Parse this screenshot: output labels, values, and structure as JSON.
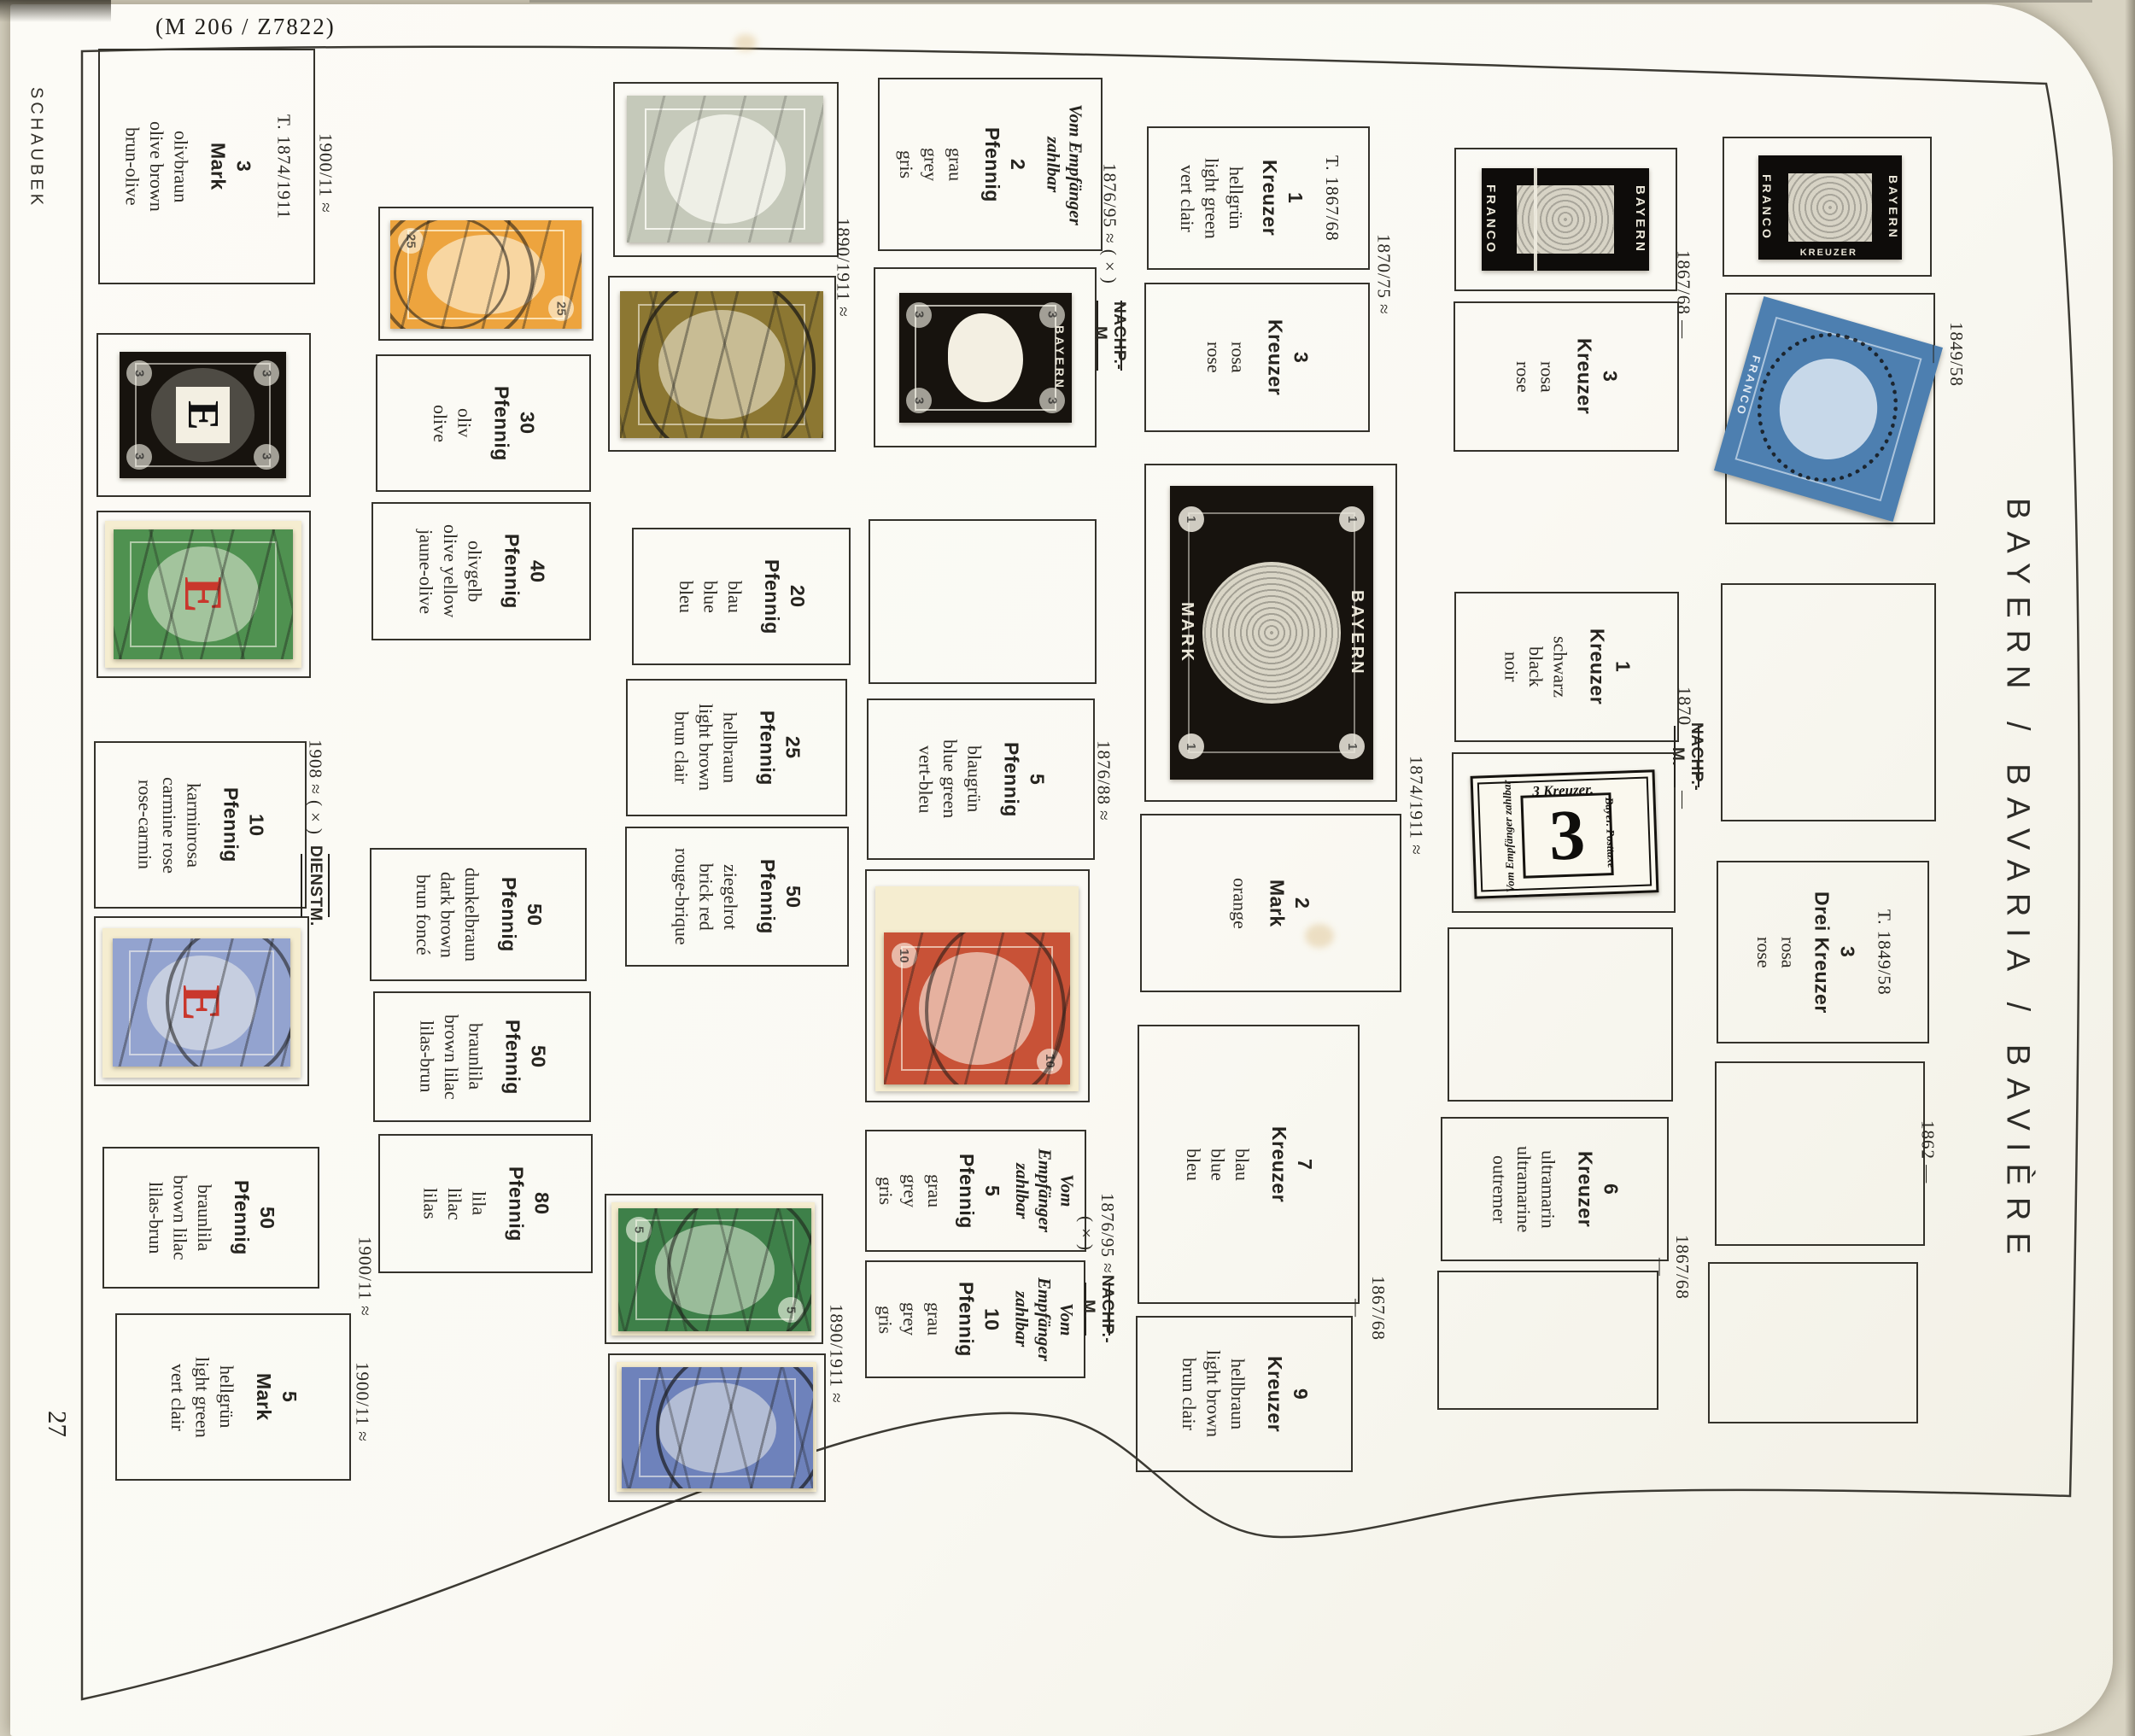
{
  "photo_label": "(M 206 / Z7822)",
  "page": {
    "brand": "SCHAUBEK",
    "number": "27",
    "title": "BAYERN / BAVARIA / BAVIÈRE"
  },
  "palette": {
    "paper": "#faf9f3",
    "frame_ink": "#34322b",
    "orange_stamp": "#eda43e",
    "grey_stamp": "#c5c9ba",
    "olive_stamp": "#8c7732",
    "green_stamp": "#3e8049",
    "blue_stamp": "#6e82bb",
    "red_stamp": "#c85237",
    "official_green": "#4f9150",
    "official_blue": "#93a3cf",
    "black_stamp": "#17130e",
    "blue_1849": "#4d7fb0",
    "overprint_red": "#c9372c",
    "backing": "#f5edd0"
  },
  "annotations": [
    {
      "text": "1900/11 ≈"
    },
    {
      "text": "1908 ≈ (×)"
    },
    {
      "text": "DIENSTM."
    },
    {
      "text": "1900/11 ≈"
    },
    {
      "text": "1900/11 ≈"
    },
    {
      "text": "1890/1911 ≈"
    },
    {
      "text": "1890/1911 ≈"
    },
    {
      "text": "1876/95 ≈ (×)"
    },
    {
      "text": "NACHP.-M."
    },
    {
      "text": "1876/88 ≈"
    },
    {
      "text": "1876/95 ≈ (×)"
    },
    {
      "text": "NACHP.-M."
    },
    {
      "text": "1870/75 ≈"
    },
    {
      "text": "1874/1911 ≈"
    },
    {
      "text": "1867/68 —"
    },
    {
      "text": "1867/68 —"
    },
    {
      "text": "1870"
    },
    {
      "text": "NACHP.-M."
    },
    {
      "text": "—"
    },
    {
      "text": "1867/68 —"
    },
    {
      "text": "1849/58 —"
    },
    {
      "text": "1862 —"
    }
  ],
  "stamp_text": {
    "bayern": "BAYERN",
    "mark": "MARK",
    "franco": "FRANCO",
    "kreuzer": "KREUZER",
    "e": "E",
    "one": "1",
    "due_top": "3 Kreuzer.",
    "due_big": "3",
    "due_left": "Vom Empfänger zahlbar",
    "due_right": "Bayer. Posttaxe"
  },
  "columns": [
    {
      "boxes": [
        {
          "type": "label",
          "header": "T. 1874/1911",
          "vu": [
            "3",
            "Mark"
          ],
          "colors": [
            "olivbraun",
            "olive brown",
            "brun-olive"
          ]
        },
        {
          "type": "stamp",
          "name": "3 Pfennig official black, E overprint",
          "denom": "3"
        },
        {
          "type": "stamp",
          "name": "5 Pfennig official green, red E overprint",
          "denom": "5"
        },
        {
          "type": "label",
          "vu": [
            "10",
            "Pfennig"
          ],
          "colors": [
            "karminrosa",
            "carmine rose",
            "rose-carmin"
          ]
        },
        {
          "type": "stamp",
          "name": "20 Pfennig official ultramarine, red E overprint",
          "denom": "20"
        },
        {
          "type": "label",
          "vu": [
            "50",
            "Pfennig"
          ],
          "colors": [
            "braunlila",
            "brown lilac",
            "lilas-brun"
          ]
        },
        {
          "type": "label",
          "vu": [
            "5",
            "Mark"
          ],
          "colors": [
            "hellgrün",
            "light green",
            "vert clair"
          ]
        }
      ]
    },
    {
      "boxes": [
        {
          "type": "stamp",
          "name": "25 Pfennig orange, used",
          "denom": "25"
        },
        {
          "type": "label",
          "vu": [
            "30",
            "Pfennig"
          ],
          "colors": [
            "oliv",
            "olive"
          ]
        },
        {
          "type": "label",
          "vu": [
            "40",
            "Pfennig"
          ],
          "colors": [
            "olivgelb",
            "olive yellow",
            "jaune-olive"
          ]
        },
        {
          "type": "label",
          "vu": [
            "50",
            "Pfennig"
          ],
          "colors": [
            "dunkelbraun",
            "dark brown",
            "brun foncé"
          ]
        },
        {
          "type": "label",
          "vu": [
            "50",
            "Pfennig"
          ],
          "colors": [
            "braunlila",
            "brown lilac",
            "lilas-brun"
          ]
        },
        {
          "type": "label",
          "vu": [
            "80",
            "Pfennig"
          ],
          "colors": [
            "lila",
            "lilac",
            "lilas"
          ]
        }
      ]
    },
    {
      "boxes": [
        {
          "type": "stamp",
          "name": "2 Pfennig grey, used",
          "denom": "2"
        },
        {
          "type": "stamp",
          "name": "3 Pfennig olive-brown, used",
          "denom": "3"
        },
        {
          "type": "label",
          "vu": [
            "20",
            "Pfennig"
          ],
          "colors": [
            "blau",
            "blue",
            "bleu"
          ]
        },
        {
          "type": "label",
          "vu": [
            "25",
            "Pfennig"
          ],
          "colors": [
            "hellbraun",
            "light brown",
            "brun clair"
          ]
        },
        {
          "type": "label",
          "vu": [
            "50",
            "Pfennig"
          ],
          "colors": [
            "ziegelrot",
            "brick red",
            "rouge-brique"
          ]
        },
        {
          "type": "stamp",
          "name": "5 Pfennig green, used",
          "denom": "5"
        },
        {
          "type": "stamp",
          "name": "20 Pfennig ultramarine, used",
          "denom": "20"
        }
      ]
    },
    {
      "boxes": [
        {
          "type": "label",
          "pre": [
            "Vom Empfänger",
            "zahlbar"
          ],
          "vu": [
            "2",
            "Pfennig"
          ],
          "colors": [
            "grau",
            "grey",
            "gris"
          ]
        },
        {
          "type": "stamp",
          "name": "3 Pfennig postage due, black",
          "denom": "3"
        },
        {
          "type": "empty"
        },
        {
          "type": "label",
          "vu": [
            "5",
            "Pfennig"
          ],
          "colors": [
            "blaugrün",
            "blue green",
            "vert-bleu"
          ]
        },
        {
          "type": "stamp",
          "name": "10 Pfennig vermilion, used",
          "denom": "10"
        },
        {
          "type": "label",
          "pre": [
            "Vom Empfänger",
            "zahlbar"
          ],
          "vu": [
            "5",
            "Pfennig"
          ],
          "colors": [
            "grau",
            "grey",
            "gris"
          ]
        },
        {
          "type": "label",
          "pre": [
            "Vom Empfänger",
            "zahlbar"
          ],
          "vu": [
            "10",
            "Pfennig"
          ],
          "colors": [
            "grau",
            "grey",
            "gris"
          ]
        }
      ]
    },
    {
      "boxes": [
        {
          "type": "label",
          "header": "T. 1867/68",
          "vu": [
            "1",
            "Kreuzer"
          ],
          "colors": [
            "hellgrün",
            "light green",
            "vert clair"
          ]
        },
        {
          "type": "label",
          "vu": [
            "3",
            "Kreuzer"
          ],
          "colors": [
            "rosa",
            "rose"
          ]
        },
        {
          "type": "stamp",
          "name": "1 Mark black",
          "denom": "1"
        },
        {
          "type": "label",
          "vu": [
            "2",
            "Mark"
          ],
          "colors": [
            "orange"
          ]
        },
        {
          "type": "label",
          "vu": [
            "7",
            "Kreuzer"
          ],
          "colors": [
            "blau",
            "blue",
            "bleu"
          ]
        },
        {
          "type": "label",
          "vu": [
            "9",
            "Kreuzer"
          ],
          "colors": [
            "hellbraun",
            "light brown",
            "brun clair"
          ]
        }
      ]
    },
    {
      "boxes": [
        {
          "type": "stamp",
          "name": "1 Kreuzer black 1849",
          "denom": "1"
        },
        {
          "type": "label",
          "vu": [
            "3",
            "Kreuzer"
          ],
          "colors": [
            "rosa",
            "rose"
          ]
        },
        {
          "type": "label",
          "vu": [
            "1",
            "Kreuzer"
          ],
          "colors": [
            "schwarz",
            "black",
            "noir"
          ]
        },
        {
          "type": "stamp",
          "name": "3 Kreuzer postage due, black numeral",
          "denom": "3"
        },
        {
          "type": "empty"
        },
        {
          "type": "label",
          "vu": [
            "6",
            "Kreuzer"
          ],
          "colors": [
            "ultramarin",
            "ultramarine",
            "outremer"
          ]
        },
        {
          "type": "empty"
        }
      ]
    },
    {
      "boxes": [
        {
          "type": "stamp",
          "name": "1 Kreuzer black, Schwarzer Einser",
          "denom": "1"
        },
        {
          "type": "stamp",
          "name": "3 Kreuzer blue 1849, used, mounted tilted",
          "denom": "3"
        },
        {
          "type": "empty"
        },
        {
          "type": "label",
          "header": "T. 1849/58",
          "vu": [
            "3",
            "Drei Kreuzer"
          ],
          "colors": [
            "rosa",
            "rose"
          ]
        },
        {
          "type": "empty"
        },
        {
          "type": "empty"
        }
      ]
    }
  ]
}
